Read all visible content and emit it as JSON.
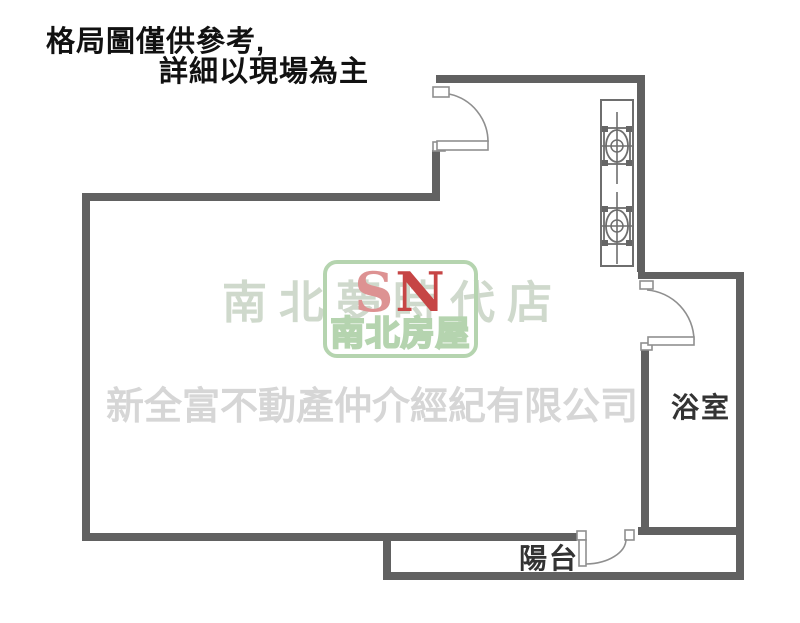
{
  "notice": {
    "line1": "格局圖僅供參考,",
    "line2": "詳細以現場為主"
  },
  "room_labels": {
    "bathroom": "浴室",
    "balcony": "陽台"
  },
  "watermark": {
    "brand_store_line": "南北夢時代店",
    "company_line": "新全富不動產仲介經紀有限公司",
    "logo": {
      "letter_s": "S",
      "letter_n": "N",
      "brand_name": "南北房屋"
    }
  },
  "fixtures": {
    "stove": "gas-stove-two-burner",
    "doors": [
      "entry-door-top",
      "bathroom-door",
      "balcony-door"
    ]
  },
  "colors": {
    "wall": "#616161",
    "door": "#8f8f8f",
    "stove": "#6e6e6e",
    "label-text": "#333333",
    "notice-text": "#111111",
    "brand-green": "#cfd9cc",
    "company-gray": "#d6d6d6",
    "logo-border": "#b5d4af",
    "logo-s": "#dd9292",
    "logo-n": "#c64545",
    "logo-name-fill": "#ffffff"
  }
}
